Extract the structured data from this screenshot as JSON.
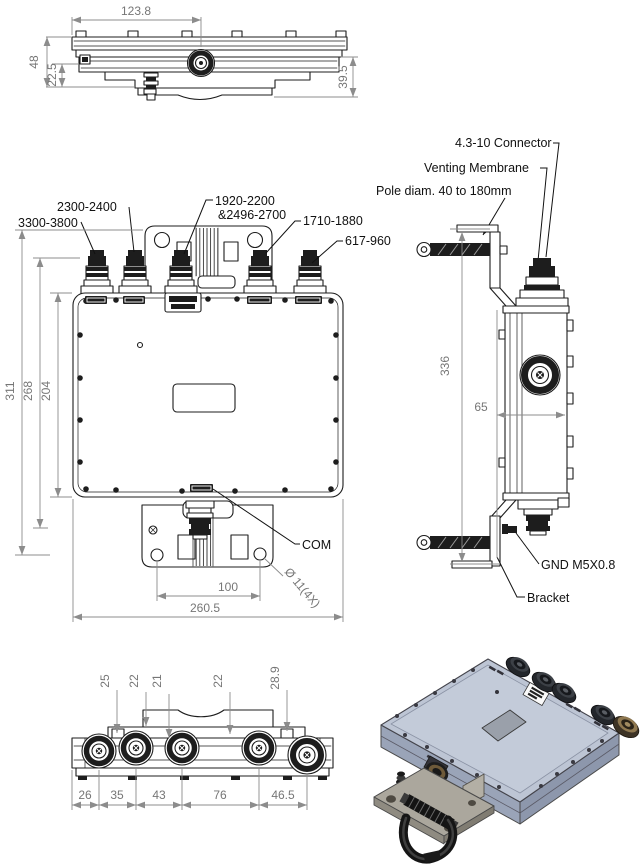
{
  "drawing": {
    "kind": "technical-outline-drawing",
    "views": {
      "top": {
        "dim_center_offset": "123.8",
        "dim_total_height": "48",
        "dim_step_height": "22.5",
        "dim_bracket_depth": "39.5"
      },
      "front": {
        "port_labels": [
          "3300-3800",
          "2300-2400",
          "1920-2200",
          "&2496-2700",
          "1710-1880",
          "617-960"
        ],
        "dim_height_overall": "311",
        "dim_height_flange": "268",
        "dim_height_body": "204",
        "com_label": "COM",
        "dim_hole_pitch": "100",
        "dim_width_overall": "260.5",
        "hole_callout": "Ø 11(4X)"
      },
      "side": {
        "callout_connector": "4.3-10 Connector",
        "callout_venting": "Venting Membrane",
        "callout_pole": "Pole diam. 40 to 180mm",
        "dim_height_overall": "336",
        "dim_bracket_offset": "65",
        "callout_gnd": "GND M5X0.8",
        "callout_bracket": "Bracket"
      },
      "bottom": {
        "dim_offsets_top": [
          "25",
          "22",
          "21",
          "22",
          "28.9"
        ],
        "dim_spacings_bottom": [
          "26",
          "35",
          "43",
          "76",
          "46.5"
        ]
      }
    },
    "colors": {
      "line": "#1d1d1d",
      "dim_line": "#8c8c8c",
      "dim_text": "#767676",
      "callout_text": "#111111",
      "iso_top_face": "#bdc5d4",
      "iso_side_face": "#9aa4b8",
      "iso_label_plate": "#9aa0aa",
      "iso_bracket": "#aba79d",
      "iso_clamp": "#151515",
      "iso_connector_bronze": "#6e5a3a"
    }
  }
}
